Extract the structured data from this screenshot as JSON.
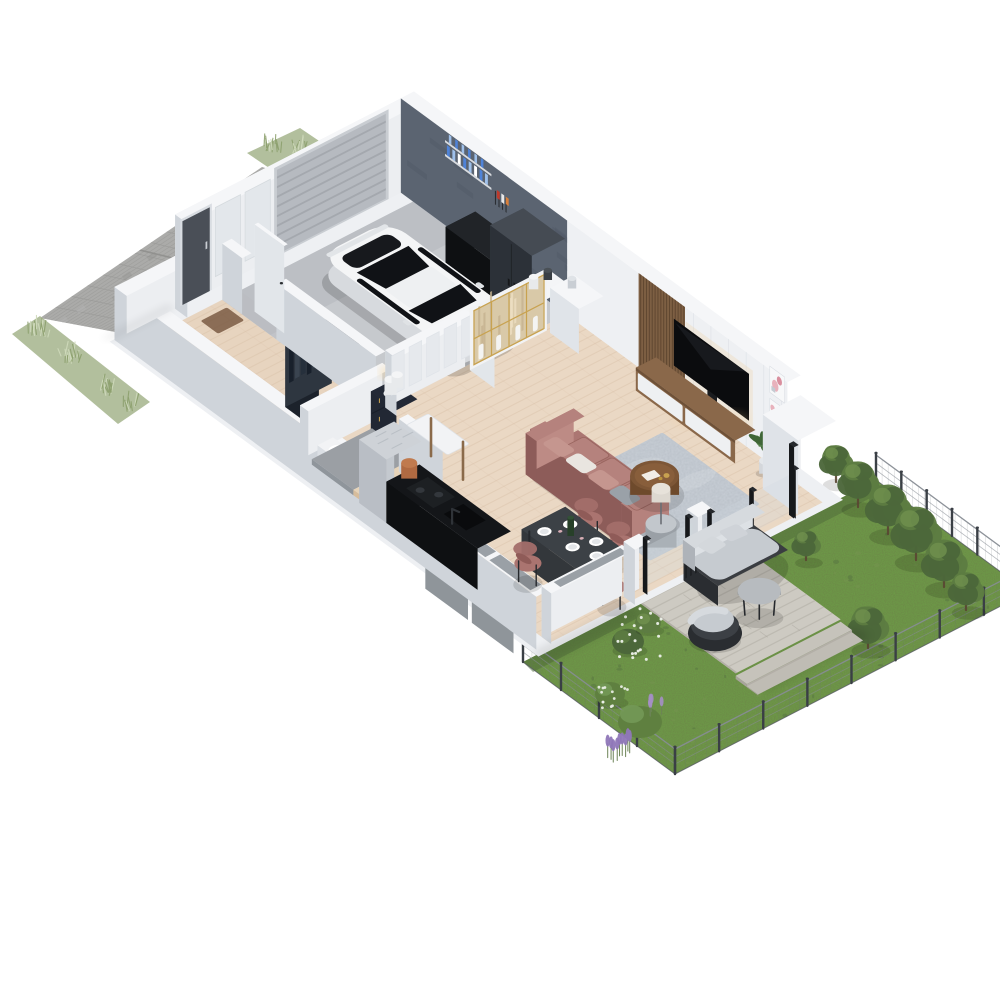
{
  "scene": {
    "title": "3D isometric cutaway floor plan — ground floor with garage, driveway, terrace and garden",
    "type": "architectural visualization render",
    "background": "#ffffff"
  },
  "areas": {
    "driveway": {
      "label": "Paved driveway",
      "items": [
        "concrete paver grid",
        "lawn edge strips",
        "ornamental grasses"
      ]
    },
    "garage": {
      "label": "Garage",
      "items": [
        "white sports car",
        "sectional garage door",
        "black sideboard",
        "grey tall cabinet",
        "wall shelves with blue bottles",
        "tool board",
        "concrete walls"
      ]
    },
    "entrance_hall": {
      "label": "Entrance hall",
      "items": [
        "front door",
        "open wardrobe with hanging clothes",
        "doormat",
        "open interior door"
      ]
    },
    "bathroom": {
      "label": "Bathroom",
      "items": [
        "navy vanity with gold faucet",
        "toilet",
        "grey floor"
      ]
    },
    "staircase": {
      "label": "Staircase",
      "items": [
        "timber winder steps",
        "grey landing",
        "white console table"
      ]
    },
    "kitchen": {
      "label": "Kitchen",
      "items": [
        "black countertop run",
        "hob",
        "sink with black faucet",
        "marble utility column",
        "terracotta pot",
        "dark window"
      ]
    },
    "dining": {
      "label": "Dining area",
      "items": [
        "dark rectangular table",
        "mauve shell chairs",
        "white plates",
        "wine bottle"
      ]
    },
    "living_room": {
      "label": "Living room",
      "items": [
        "dusty-pink sofa",
        "grey-blue rug",
        "round walnut coffee table",
        "drum side table with lamp",
        "brass-framed display cabinet",
        "herringbone oak floor"
      ]
    },
    "media_wall": {
      "label": "TV wall",
      "items": [
        "wall-mounted TV",
        "walnut media console with white drawers",
        "wood slat panel",
        "two stacked pink artworks",
        "potted plant",
        "white corner unit"
      ]
    },
    "terrace": {
      "label": "Terrace",
      "items": [
        "timber deck",
        "outdoor sofa",
        "outdoor armchair",
        "round coffee table",
        "deck steps",
        "sliding glass doors"
      ]
    },
    "garden": {
      "label": "Garden",
      "items": [
        "lawn",
        "wire mesh fence with posts",
        "row of trees",
        "boxwood ball",
        "lavender",
        "white flowering shrubs",
        "grey window sills"
      ]
    }
  },
  "palette": {
    "bg": "#ffffff",
    "paver": "#ababa9",
    "paverLite": "#b8b8b6",
    "paverLine": "#999997",
    "paverSeam": "#8f8f8d",
    "lawnPale": "#aab892",
    "lawnStroke": "#8da06e",
    "lawnStrokeLite": "#cfdabb",
    "grass": "#63813f",
    "grassDark": "#597741",
    "grassLight": "#75934e",
    "grassShadow": "#4e693a",
    "wallTop": "#f5f6f8",
    "wallNW": "#eceef1",
    "wallSW": "#cfd4da",
    "wallEdge": "#d8dce2",
    "panelGroove": "#dfe3e8",
    "concrete": "#5b6471",
    "concreteDark": "#4e5663",
    "garageFloor": "#c6c9cd",
    "garageFloorDark": "#b8bbc0",
    "garageDoor": "#b6bac0",
    "garageDoorLine": "#a4a8ae",
    "doorFrame": "#c9cdd2",
    "frontDoor": "#4a4f57",
    "carBody": "#f4f5f6",
    "carShade": "#d7dade",
    "carGlass": "#101216",
    "carDark": "#17191d",
    "carDetail": "#2b2e33",
    "cabinetDark": "#191b1e",
    "cabinetDarkTop": "#212428",
    "cabinetGrey": "#3a4047",
    "cabinetGreyFace": "#2c3138",
    "cabinetGreyTop": "#454b53",
    "bottleBlue": "#4f83d8",
    "bottleLight": "#9fc0ea",
    "sprayRed": "#c0392b",
    "sprayWhite": "#e8e8e8",
    "slatWood": "#7d5f43",
    "slatLine": "#5f4630",
    "consoleWood": "#8a684a",
    "consoleWoodDark": "#6e5138",
    "drawerWhite": "#eef0f2",
    "tvBlack": "#0b0c0e",
    "tvSheen": "#23262c",
    "ledGlow": "#f2c98f",
    "artPink": "#e8b2bc",
    "artRose": "#d98f9e",
    "artGrey": "#c4cbd2",
    "frameWhite": "#f7f8f9",
    "plantGreen": "#54804a",
    "plantDark": "#3f6637",
    "floorWood": "#ead8c4",
    "floorWoodHall": "#e7d4bf",
    "floorWoodLine": "#d8bfa4",
    "rug": "#b6bdc5",
    "rugDark": "#9da6b0",
    "rugLight": "#d0d5da",
    "sofa": "#ab7672",
    "sofaFace": "#b5827d",
    "sofaDark": "#8d5c59",
    "cushionLight": "#c5968f",
    "pillowWhite": "#e9e5e0",
    "pillowGrey": "#9aa1a8",
    "tableWood": "#7d5636",
    "tableWoodDark": "#6e4a2c",
    "tableWoodRim": "#8f6440",
    "gold": "#c8a250",
    "drum": "#b5bac0",
    "drumTop": "#c2c7cc",
    "lampShade": "#ddd8d0",
    "diningTop": "#3c4146",
    "diningSide": "#33373b",
    "chairMauve": "#a36e6a",
    "chairSeat": "#aa7470",
    "chairDark": "#26292d",
    "kitchenBlack": "#141619",
    "kitchenFace": "#232629",
    "kitchenDark": "#0e1012",
    "hob": "#1d2023",
    "marble": "#ced2d7",
    "marbleNW": "#c4c9cf",
    "marbleSW": "#b9bec5",
    "marbleStreak": "#b0b6bd",
    "terracotta": "#b06a42",
    "terracottaLite": "#c07a4e",
    "vanityNavy": "#232936",
    "vanityFace": "#343c4c",
    "vanitySide": "#222834",
    "glow": "#f5d9a8",
    "landingGrey": "#9b9fa4",
    "landingFace": "#8f959b",
    "glassGrey": "#9aa0a6",
    "glassDark": "#3a3f46",
    "glassPale": "#cfd9de",
    "sillTop": "#a8adb2",
    "sillFace": "#9aa0a5",
    "mat": "#7a5b43",
    "deck": "#cdcac2",
    "deckLine": "#b9b5ac",
    "deckEdge": "#b3afa7",
    "deckStep1": "#c6c3bb",
    "deckStep2": "#bfbcb4",
    "deckShade": "#a8a49c",
    "outCushion": "#c6cbd0",
    "outCushionHi": "#d6dade",
    "outCushionLo": "#aeb3b9",
    "wicker": "#2a2d31",
    "wickerFace": "#44484d",
    "outTable": "#b7bbbf",
    "outTableSide": "#8f9499",
    "fencePost": "#3a3f45",
    "fenceWire": "#878d94",
    "fenceMesh": "#6a7076",
    "treeGreen": "#5d7c42",
    "treeLight": "#6f8f4e",
    "treeDark": "#4c673a",
    "trunk": "#5a4632",
    "bushGreen": "#5f8040",
    "bushHi": "#739856",
    "flowerWhite": "#edf1ea",
    "lavender": "#8f77b8",
    "lavenderStem": "#6c8456",
    "shadow": "#000000",
    "stepWood": "#e6d3b8",
    "stepRiser": "#d7bd9c",
    "white": "#f2f3f5"
  }
}
